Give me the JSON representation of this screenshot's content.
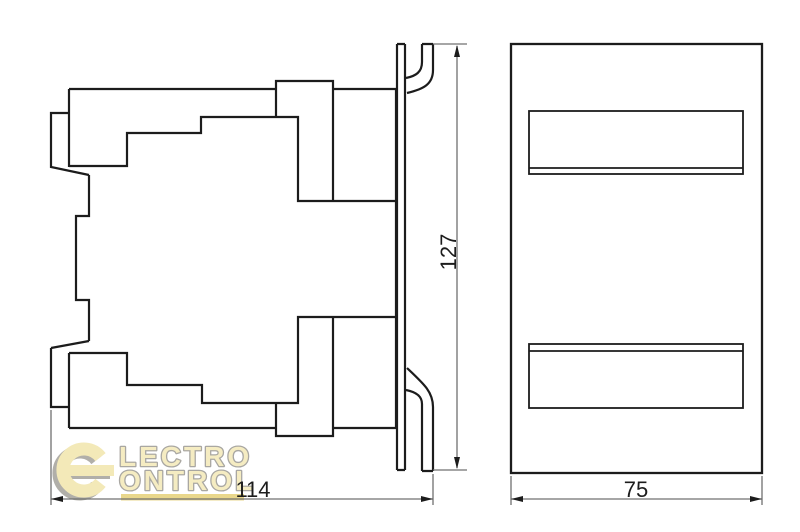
{
  "dimensions": {
    "side_height": "127",
    "side_width": "114",
    "front_width": "75"
  },
  "logo": {
    "monogram": "e",
    "line1": "LECTRO",
    "line2": "ONTROL"
  },
  "icons": {
    "logo": "electro-control-logo"
  },
  "colors": {
    "background": "#ffffff",
    "line": "#1c1c1c",
    "dimension_line": "#707070",
    "logo_fill": "#f3e9b8",
    "logo_text_fill": "#f5ecc2",
    "logo_outline": "#a9a7a2",
    "logo_bar": "#e9d78c",
    "logo_shadow": "#b1afa9"
  }
}
